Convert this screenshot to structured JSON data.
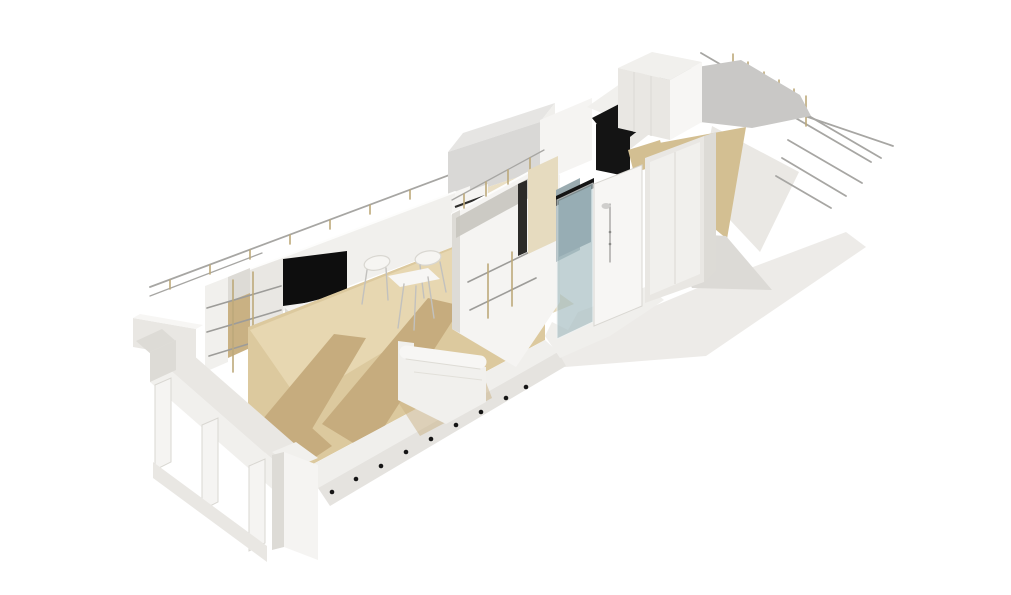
{
  "meta": {
    "description": "Axonometric 3D cutaway rendering of a narrow apartment interior with living room, bathroom core, wardrobes and terrace",
    "canvas_width": 1011,
    "canvas_height": 595,
    "background": "#ffffff"
  },
  "colors": {
    "background": "#ffffff",
    "wall_white": "#f5f4f2",
    "wall_light": "#f1f0ed",
    "wall_shaded": "#e9e7e3",
    "wall_dark": "#dddbd6",
    "wall_backdrop": "#f7f6f4",
    "slab_light": "#f0efec",
    "slab_mid": "#e5e3df",
    "ground_plane": "#ebe9e5",
    "deck_gray": "#c9c8c6",
    "panel_gray": "#c8c5bf",
    "terrace_wall": "#eae8e4",
    "terrace_slab": "#dcdad6",
    "floor_wood": "#dcc99e",
    "floor_light": "#e7d7b1",
    "floor_shadow": "#c6ac7e",
    "floor_muted": "#d3bf92",
    "tile_beige": "#e6dbbf",
    "beige_strip": "#eadfc4",
    "base_beige": "#e4d8ba",
    "glass_teal": "#a9c0c4",
    "glass_deep": "#6e8290",
    "glass_gray": "#9aabb0",
    "mirror_dark": "#2c2b29",
    "tv_black": "#0e0e0e",
    "door_black": "#141414",
    "rail_gray": "#a7a6a3",
    "brass": "#bda97a",
    "concrete": "#d9d8d6",
    "concrete_top": "#e6e5e3",
    "shadow_warm": "#c9b183",
    "dot_black": "#151515"
  },
  "scene": {
    "type": "architectural-3d-cutaway",
    "rooms": [
      "entry",
      "living-room",
      "dining-area",
      "bathroom-core",
      "wardrobe-hall",
      "terrace"
    ],
    "objects": [
      "wall-tv",
      "media-sideboard",
      "open-shelving",
      "dining-table",
      "chair",
      "chair",
      "sofa",
      "shower-glass",
      "shower-column",
      "mirror",
      "wardrobe-doors",
      "tall-cabinet",
      "mezzanine-deck",
      "cable-railing",
      "handrail",
      "window-frame",
      "floor-downlights"
    ]
  }
}
